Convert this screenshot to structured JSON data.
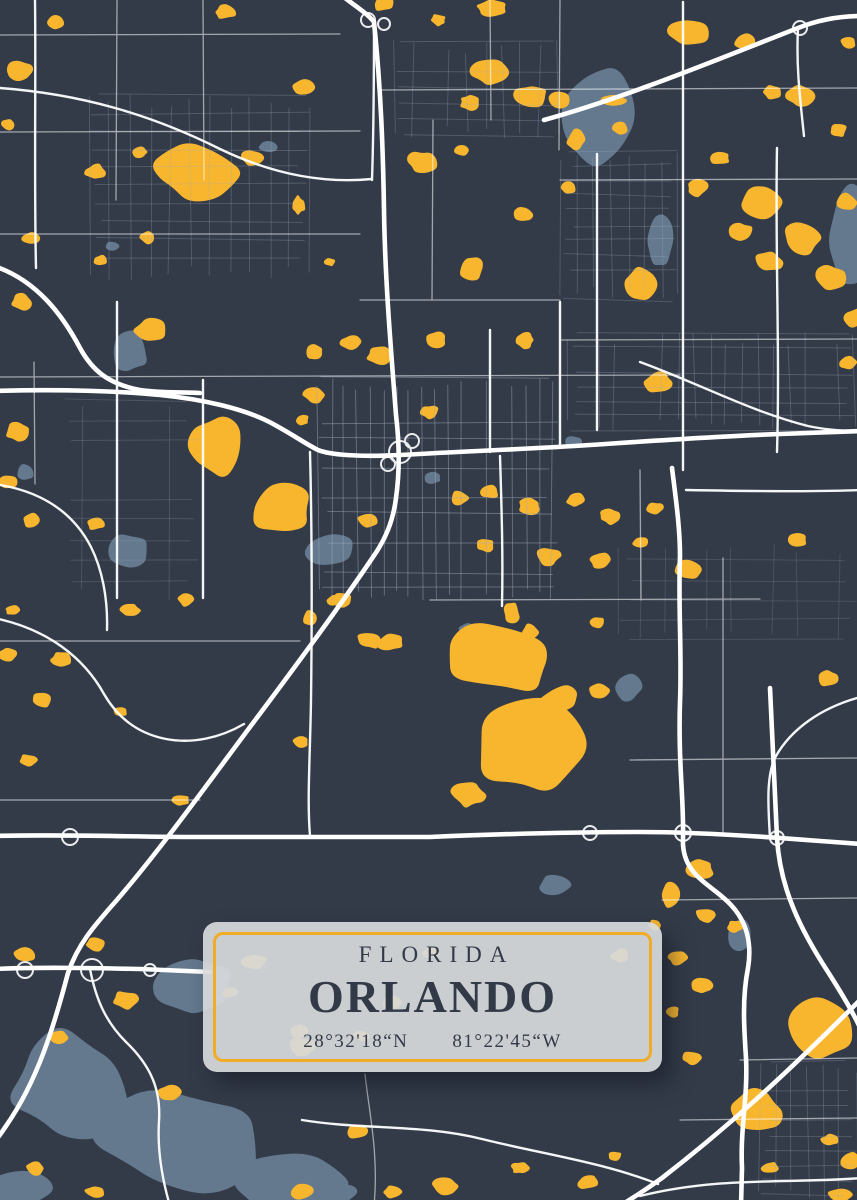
{
  "poster": {
    "state_label": "FLORIDA",
    "city_label": "ORLANDO",
    "latitude_label": "28°32'18“N",
    "longitude_label": "81°22'45“W"
  },
  "colors": {
    "background": "#333B49",
    "lake_yellow": "#F8B62E",
    "water_gray": "#64798E",
    "road_white": "#FFFFFF",
    "road_minor": "#9FA9BA",
    "card_fill": "#D7D9DC",
    "card_border": "#F0AC26",
    "text_dark": "#323A48"
  },
  "map": {
    "width": 857,
    "height": 1200,
    "lakes_gray": [
      [
        600,
        118,
        34,
        48,
        0.45
      ],
      [
        660,
        240,
        13,
        26,
        0.35
      ],
      [
        850,
        242,
        22,
        52,
        0.4
      ],
      [
        130,
        352,
        18,
        20,
        0.4
      ],
      [
        126,
        551,
        22,
        18,
        0.35
      ],
      [
        330,
        550,
        26,
        16,
        0.3
      ],
      [
        268,
        146,
        10,
        6,
        0.4
      ],
      [
        573,
        442,
        8,
        6,
        0.4
      ],
      [
        433,
        478,
        8,
        6,
        0.4
      ],
      [
        628,
        688,
        13,
        14,
        0.4
      ],
      [
        468,
        630,
        9,
        7,
        0.4
      ],
      [
        25,
        472,
        9,
        8,
        0.4
      ],
      [
        112,
        246,
        7,
        5,
        0.4
      ],
      [
        555,
        885,
        16,
        10,
        0.4
      ],
      [
        740,
        935,
        12,
        16,
        0.45
      ],
      [
        337,
        1192,
        18,
        10,
        0.4
      ],
      [
        70,
        1085,
        60,
        55,
        0.5
      ],
      [
        180,
        1140,
        85,
        50,
        0.5
      ],
      [
        290,
        1185,
        55,
        28,
        0.45
      ],
      [
        195,
        985,
        40,
        30,
        0.5
      ],
      [
        20,
        1190,
        30,
        18,
        0.4
      ]
    ],
    "lakes_yellow": [
      [
        20,
        70,
        14,
        10
      ],
      [
        55,
        22,
        9,
        7
      ],
      [
        8,
        125,
        7,
        6
      ],
      [
        225,
        12,
        10,
        7
      ],
      [
        302,
        88,
        12,
        9
      ],
      [
        383,
        4,
        11,
        7
      ],
      [
        438,
        20,
        8,
        6
      ],
      [
        492,
        8,
        15,
        8
      ],
      [
        490,
        72,
        18,
        12
      ],
      [
        532,
        95,
        16,
        11
      ],
      [
        470,
        102,
        10,
        8
      ],
      [
        560,
        100,
        11,
        9
      ],
      [
        576,
        140,
        9,
        10
      ],
      [
        620,
        128,
        8,
        6
      ],
      [
        614,
        100,
        12,
        6
      ],
      [
        688,
        33,
        20,
        13
      ],
      [
        745,
        42,
        11,
        8
      ],
      [
        800,
        96,
        14,
        10
      ],
      [
        838,
        130,
        9,
        7
      ],
      [
        772,
        92,
        9,
        7
      ],
      [
        848,
        42,
        8,
        6
      ],
      [
        195,
        172,
        42,
        26,
        0.5
      ],
      [
        95,
        172,
        10,
        8
      ],
      [
        140,
        152,
        8,
        6
      ],
      [
        252,
        158,
        11,
        8
      ],
      [
        298,
        205,
        7,
        9
      ],
      [
        422,
        162,
        15,
        11
      ],
      [
        462,
        150,
        8,
        6
      ],
      [
        522,
        215,
        10,
        8
      ],
      [
        568,
        188,
        8,
        6
      ],
      [
        720,
        158,
        10,
        7
      ],
      [
        698,
        188,
        11,
        8
      ],
      [
        762,
        202,
        24,
        18,
        0.45
      ],
      [
        802,
        238,
        20,
        16,
        0.45
      ],
      [
        832,
        278,
        16,
        13
      ],
      [
        768,
        262,
        14,
        11
      ],
      [
        740,
        232,
        12,
        10
      ],
      [
        846,
        202,
        10,
        8
      ],
      [
        855,
        318,
        11,
        9
      ],
      [
        30,
        238,
        9,
        6
      ],
      [
        148,
        238,
        8,
        6
      ],
      [
        100,
        260,
        7,
        5
      ],
      [
        330,
        262,
        6,
        4
      ],
      [
        472,
        268,
        13,
        13
      ],
      [
        22,
        302,
        11,
        8
      ],
      [
        848,
        362,
        9,
        7
      ],
      [
        640,
        285,
        16,
        16
      ],
      [
        150,
        330,
        15,
        12
      ],
      [
        315,
        352,
        9,
        7
      ],
      [
        352,
        342,
        11,
        8
      ],
      [
        380,
        356,
        13,
        9
      ],
      [
        436,
        340,
        11,
        8
      ],
      [
        524,
        340,
        11,
        8
      ],
      [
        315,
        395,
        11,
        8
      ],
      [
        302,
        420,
        7,
        6
      ],
      [
        430,
        412,
        9,
        7
      ],
      [
        658,
        382,
        15,
        11
      ],
      [
        215,
        446,
        26,
        30,
        0.4
      ],
      [
        282,
        510,
        30,
        26,
        0.45
      ],
      [
        18,
        432,
        13,
        9
      ],
      [
        8,
        482,
        9,
        7
      ],
      [
        32,
        520,
        11,
        8
      ],
      [
        95,
        524,
        9,
        6
      ],
      [
        368,
        520,
        10,
        7
      ],
      [
        342,
        600,
        10,
        7
      ],
      [
        460,
        498,
        9,
        7
      ],
      [
        490,
        492,
        9,
        7
      ],
      [
        530,
        506,
        11,
        8
      ],
      [
        576,
        500,
        9,
        7
      ],
      [
        610,
        516,
        11,
        8
      ],
      [
        655,
        508,
        8,
        6
      ],
      [
        690,
        570,
        14,
        10
      ],
      [
        798,
        540,
        9,
        7
      ],
      [
        485,
        545,
        9,
        7
      ],
      [
        548,
        556,
        13,
        9
      ],
      [
        600,
        560,
        11,
        8
      ],
      [
        640,
        542,
        8,
        6
      ],
      [
        130,
        610,
        10,
        7
      ],
      [
        185,
        600,
        8,
        6
      ],
      [
        62,
        660,
        11,
        8
      ],
      [
        8,
        655,
        9,
        7
      ],
      [
        12,
        610,
        7,
        5
      ],
      [
        310,
        618,
        7,
        7
      ],
      [
        370,
        640,
        12,
        9
      ],
      [
        335,
        600,
        8,
        6
      ],
      [
        530,
        632,
        9,
        8
      ],
      [
        597,
        622,
        7,
        6
      ],
      [
        828,
        678,
        10,
        8
      ],
      [
        505,
        658,
        55,
        36,
        0.5
      ],
      [
        532,
        748,
        52,
        46,
        0.45
      ],
      [
        468,
        795,
        16,
        12
      ],
      [
        560,
        700,
        20,
        14
      ],
      [
        512,
        612,
        8,
        10
      ],
      [
        390,
        642,
        13,
        9
      ],
      [
        42,
        700,
        10,
        7
      ],
      [
        120,
        712,
        7,
        5
      ],
      [
        28,
        760,
        9,
        6
      ],
      [
        180,
        800,
        10,
        6
      ],
      [
        300,
        742,
        8,
        6
      ],
      [
        600,
        690,
        10,
        8
      ],
      [
        700,
        868,
        14,
        10
      ],
      [
        670,
        895,
        9,
        12
      ],
      [
        706,
        916,
        11,
        8
      ],
      [
        736,
        926,
        8,
        6
      ],
      [
        678,
        958,
        9,
        7
      ],
      [
        702,
        986,
        10,
        8
      ],
      [
        672,
        1012,
        7,
        6
      ],
      [
        692,
        1058,
        9,
        7
      ],
      [
        655,
        925,
        7,
        5
      ],
      [
        822,
        1028,
        34,
        32,
        0.35
      ],
      [
        755,
        1112,
        26,
        22,
        0.4
      ],
      [
        850,
        1160,
        10,
        8
      ],
      [
        840,
        1195,
        12,
        8
      ],
      [
        770,
        1168,
        8,
        6
      ],
      [
        830,
        1140,
        9,
        6
      ],
      [
        25,
        955,
        11,
        8
      ],
      [
        95,
        945,
        9,
        7
      ],
      [
        125,
        1000,
        13,
        9
      ],
      [
        60,
        1038,
        9,
        7
      ],
      [
        230,
        992,
        8,
        6
      ],
      [
        170,
        1092,
        11,
        8
      ],
      [
        300,
        1032,
        9,
        7
      ],
      [
        358,
        1132,
        13,
        7
      ],
      [
        392,
        1192,
        9,
        6
      ],
      [
        302,
        1192,
        11,
        7
      ],
      [
        445,
        1186,
        14,
        8
      ],
      [
        520,
        1168,
        9,
        6
      ],
      [
        588,
        1182,
        11,
        7
      ],
      [
        615,
        1156,
        7,
        5
      ],
      [
        35,
        1168,
        9,
        7
      ],
      [
        95,
        1192,
        10,
        6
      ],
      [
        255,
        962,
        12,
        8
      ],
      [
        302,
        1046,
        14,
        9
      ],
      [
        392,
        1002,
        11,
        7
      ],
      [
        432,
        952,
        9,
        6
      ],
      [
        362,
        1036,
        9,
        6
      ],
      [
        620,
        956,
        10,
        7
      ]
    ],
    "roads_major": [
      "M340,-6 C352,4 366,12 374,22 C381,90 383,150 384,210 C385,280 391,350 396,415 C399,440 400,470 396,498 C393,522 385,540 373,557 C340,606 301,659 256,719 C211,779 161,849 116,901 C94,926 78,944 68,973 C54,1026 38,1080 6,1126 C2,1132 -2,1138 -6,1142",
      "M-6,391 C60,389 120,391 160,395 C200,399 245,408 275,425 C295,436 306,444 318,450 C330,455 360,457 400,455 C470,451 530,449 590,445 C650,441 720,436 780,434 L862,431",
      "M-6,836 C60,834 130,837 200,837 L430,837 C500,834 570,832 640,832 C700,832 770,837 820,841 L862,844",
      "M-6,969 C40,967 90,968 140,969 C165,970 190,971 210,972",
      "M672,468 C676,500 680,528 680,556 C678,606 682,652 680,702 C678,762 684,800 683,838 C681,876 712,884 731,905 C747,922 752,944 748,968 C742,998 744,1028 746,1058 C748,1098 740,1128 742,1168 L741,1206",
      "M770,688 C772,738 775,788 777,838 C780,890 802,932 828,972 C844,997 856,1018 862,1032",
      "M862,998 C802,1058 742,1116 662,1178 C640,1194 620,1206 606,1214",
      "M544,120 C630,96 716,60 798,28 C818,20 838,16 862,16",
      "M-6,266 C36,280 62,314 80,348 C92,370 108,384 140,390 C160,393 180,392 200,393"
    ],
    "roads_medium": [
      "M798,28 C796,66 800,98 804,136",
      "M683,2 C682,140 684,300 683,470",
      "M777,148 C775,250 780,350 777,452",
      "M640,362 C700,384 752,412 808,426 C826,430 844,431 862,431",
      "M686,490 C740,491 800,492 862,490",
      "M310,452 C312,530 312,620 311,700 C310,760 307,800 310,836",
      "M-6,484 C44,491 74,514 91,547 C102,569 108,598 107,630",
      "M-6,618 C48,629 84,658 104,694 C119,720 140,734 166,739 C192,744 220,738 244,724",
      "M90,969 C96,1000 106,1022 126,1042 C151,1066 161,1090 159,1121 C157,1152 163,1182 170,1206",
      "M857,698 C822,708 792,728 776,756 C766,774 768,806 770,838",
      "M302,1120 C362,1130 422,1124 482,1139 C542,1154 602,1162 658,1184",
      "M640,1196 C720,1176 790,1184 862,1178",
      "M35,0 C36,80 34,180 36,268",
      "M0,88 C80,94 150,114 220,149 C268,172 320,184 372,179",
      "M490,330 L490,452",
      "M500,456 C502,520 503,560 502,606",
      "M117,302 L117,598",
      "M203,380 L203,598",
      "M560,302 L560,446",
      "M597,154 L597,430",
      "M372,180 C374,120 374,60 374,24"
    ],
    "roads_thin": [
      "M0,35 L340,34",
      "M380,90 L857,88",
      "M0,132 L360,131",
      "M560,180 L857,179",
      "M0,234 L360,234",
      "M360,300 L560,300",
      "M560,340 L857,339",
      "M0,377 L680,375",
      "M430,600 L760,599",
      "M0,641 L300,641",
      "M630,760 L857,758",
      "M662,900 L857,898",
      "M740,1060 L857,1058",
      "M680,1120 L857,1118",
      "M0,800 L200,800",
      "M203,0 L204,180",
      "M117,0 L116,200",
      "M490,0 L491,120",
      "M560,0 L559,150",
      "M640,470 L641,600",
      "M723,558 L723,836",
      "M34,362 L35,484",
      "M433,120 L432,300",
      "M365,1074 C369,1112 379,1154 374,1206"
    ],
    "grids": [
      [
        318,
        378,
        240,
        222,
        13,
        15,
        0.5,
        11
      ],
      [
        566,
        332,
        290,
        100,
        16,
        14,
        0.32,
        22
      ],
      [
        90,
        95,
        220,
        185,
        20,
        18,
        0.3,
        33
      ],
      [
        395,
        40,
        165,
        100,
        18,
        16,
        0.3,
        44
      ],
      [
        620,
        540,
        237,
        100,
        22,
        20,
        0.22,
        55
      ],
      [
        760,
        1060,
        97,
        140,
        16,
        15,
        0.3,
        66
      ],
      [
        60,
        400,
        140,
        200,
        22,
        20,
        0.25,
        77
      ],
      [
        560,
        150,
        120,
        150,
        17,
        15,
        0.3,
        88
      ]
    ],
    "ramps": [
      [
        400,
        452,
        11
      ],
      [
        388,
        464,
        7
      ],
      [
        412,
        441,
        7
      ],
      [
        368,
        20,
        7
      ],
      [
        384,
        24,
        6
      ],
      [
        25,
        970,
        8
      ],
      [
        92,
        970,
        11
      ],
      [
        150,
        970,
        6
      ],
      [
        70,
        837,
        8
      ],
      [
        590,
        833,
        7
      ],
      [
        683,
        833,
        8
      ],
      [
        777,
        838,
        7
      ],
      [
        800,
        28,
        7
      ]
    ]
  }
}
